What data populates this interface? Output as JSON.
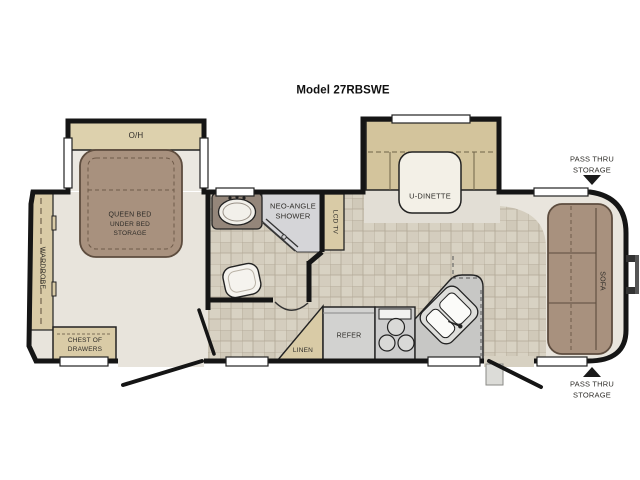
{
  "title": "Model 27RBSWE",
  "floorplan": {
    "bedroom": {
      "overhead_cabinet": "O/H",
      "bed_line1": "QUEEN BED",
      "bed_line2": "UNDER BED",
      "bed_line3": "STORAGE",
      "wardrobe": "WARDROBE",
      "chest_line1": "CHEST OF",
      "chest_line2": "DRAWERS"
    },
    "bathroom": {
      "shower_line1": "NEO-ANGLE",
      "shower_line2": "SHOWER"
    },
    "living": {
      "tv_cabinet": "LCD TV",
      "dinette": "U-DINETTE",
      "sofa": "SOFA"
    },
    "kitchen": {
      "refrigerator": "REFER",
      "linen_closet": "LINEN"
    },
    "storage_front": {
      "line1": "PASS THRU",
      "line2": "STORAGE"
    },
    "storage_rear": {
      "line1": "PASS THRU",
      "line2": "STORAGE"
    }
  },
  "colors": {
    "wall": "#151515",
    "upholstery_brown": "#a8917e",
    "cabinet_beige": "#d9cba6",
    "overhead_beige": "#ddd1ad",
    "counter_grey": "#c7c7c5",
    "shower_grey": "#d5d5d8",
    "tile_floor": "#d7d1c2",
    "plain_floor": "#e8e4dc",
    "table_white": "#f3f0e7"
  }
}
